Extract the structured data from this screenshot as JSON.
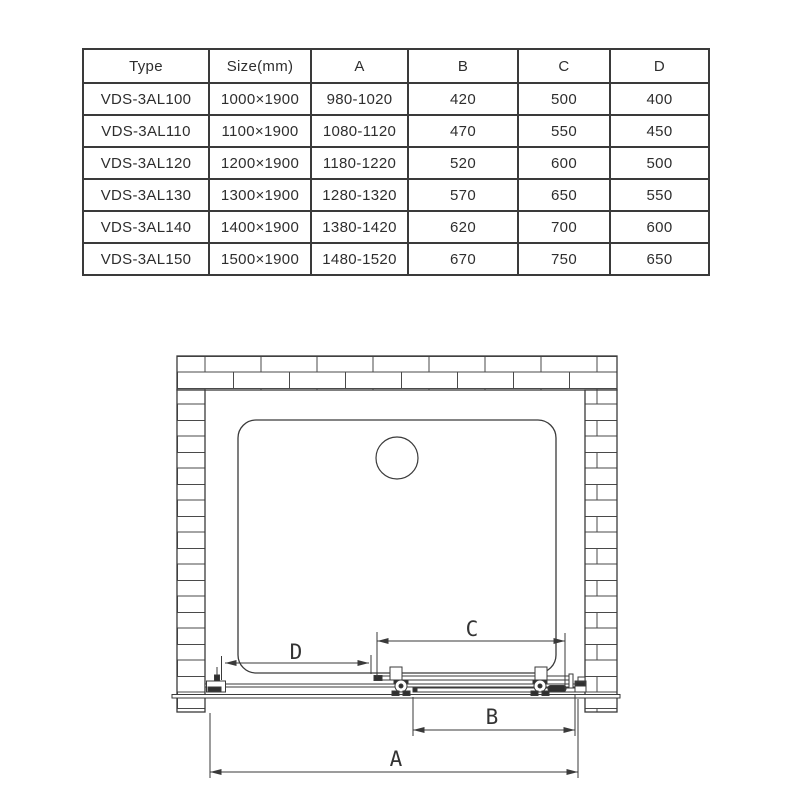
{
  "table": {
    "headers": [
      "Type",
      "Size(mm)",
      "A",
      "B",
      "C",
      "D"
    ],
    "rows": [
      [
        "VDS-3AL100",
        "1000×1900",
        "980-1020",
        "420",
        "500",
        "400"
      ],
      [
        "VDS-3AL110",
        "1100×1900",
        "1080-1120",
        "470",
        "550",
        "450"
      ],
      [
        "VDS-3AL120",
        "1200×1900",
        "1180-1220",
        "520",
        "600",
        "500"
      ],
      [
        "VDS-3AL130",
        "1300×1900",
        "1280-1320",
        "570",
        "650",
        "550"
      ],
      [
        "VDS-3AL140",
        "1400×1900",
        "1380-1420",
        "620",
        "700",
        "600"
      ],
      [
        "VDS-3AL150",
        "1500×1900",
        "1480-1520",
        "670",
        "750",
        "650"
      ]
    ]
  },
  "diagram": {
    "dim_a": "A",
    "dim_b": "B",
    "dim_c": "C",
    "dim_d": "D",
    "colors": {
      "line": "#3a3a3a",
      "fill_dark": "#2f2f2f",
      "background": "#ffffff"
    }
  }
}
